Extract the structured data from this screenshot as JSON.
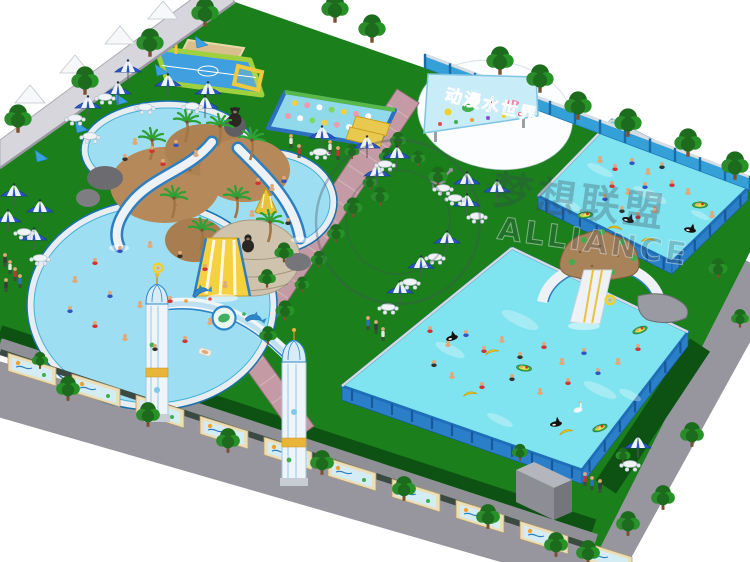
{
  "billboard": {
    "title": "动漫水世界",
    "bg": "#c9edf8",
    "text_color": "#e02828"
  },
  "watermark": {
    "cn": "梦想联盟",
    "en": "ALLIANCE"
  },
  "palette": {
    "lawn": "#1b7f1b",
    "lawn_dark": "#0d5212",
    "pool_water": "#9edef2",
    "frame_pool_water": "#7fe3f0",
    "frame_blue": "#2b7fc8",
    "pool_rim": "#e8edf2",
    "path_pink": "#c49ba4",
    "road_gray": "#97969e",
    "wall_blue": "#35a0d8",
    "wall_gray": "#d6d6dc",
    "umbrella_blue": "#2b58c8",
    "tree_green": "#2c8b2c",
    "palm_green": "#2fa035",
    "rock_tan": "#b5895a",
    "slide_yellow": "#f5d040",
    "gold": "#e8b53a",
    "billboard_bg": "#c9edf8",
    "banana_yellow": "#f2cf2a"
  },
  "scene": {
    "trees_outer": [
      [
        18,
        118
      ],
      [
        85,
        80
      ],
      [
        150,
        42
      ],
      [
        205,
        12
      ],
      [
        335,
        8
      ],
      [
        372,
        28
      ],
      [
        500,
        60
      ],
      [
        540,
        78
      ],
      [
        578,
        105
      ],
      [
        628,
        122
      ],
      [
        688,
        142
      ],
      [
        735,
        165
      ]
    ],
    "trees_road": [
      [
        68,
        388
      ],
      [
        148,
        414
      ],
      [
        228,
        440
      ],
      [
        322,
        462
      ],
      [
        404,
        488
      ],
      [
        488,
        516
      ],
      [
        556,
        544
      ],
      [
        692,
        434
      ],
      [
        663,
        497
      ],
      [
        628,
        523
      ],
      [
        588,
        552
      ]
    ],
    "trees_inner": [
      [
        352,
        151
      ],
      [
        284,
        252
      ],
      [
        267,
        278
      ],
      [
        387,
        156
      ],
      [
        370,
        182
      ],
      [
        353,
        207
      ],
      [
        336,
        233
      ],
      [
        319,
        259
      ],
      [
        302,
        284
      ],
      [
        285,
        310
      ],
      [
        268,
        335
      ],
      [
        398,
        140
      ],
      [
        418,
        158
      ],
      [
        438,
        176
      ],
      [
        380,
        196
      ],
      [
        40,
        360
      ],
      [
        623,
        455
      ],
      [
        718,
        268
      ],
      [
        740,
        318
      ],
      [
        520,
        452
      ]
    ],
    "palms": [
      [
        150,
        160
      ],
      [
        185,
        142
      ],
      [
        218,
        146
      ],
      [
        250,
        160
      ],
      [
        172,
        218
      ],
      [
        235,
        218
      ],
      [
        268,
        242
      ],
      [
        200,
        250
      ]
    ],
    "canopy_tents": [
      [
        30,
        92
      ],
      [
        75,
        62
      ],
      [
        120,
        33
      ],
      [
        163,
        8
      ]
    ],
    "wall_braces": [
      [
        35,
        150
      ],
      [
        75,
        121
      ],
      [
        115,
        93
      ],
      [
        155,
        64
      ],
      [
        195,
        36
      ]
    ],
    "umbrellas": [
      [
        128,
        72
      ],
      [
        168,
        86
      ],
      [
        208,
        94
      ],
      [
        118,
        94
      ],
      [
        205,
        108
      ],
      [
        88,
        108
      ],
      [
        14,
        196
      ],
      [
        40,
        212
      ],
      [
        8,
        222
      ],
      [
        34,
        240
      ],
      [
        367,
        148
      ],
      [
        397,
        158
      ],
      [
        377,
        176
      ],
      [
        467,
        184
      ],
      [
        497,
        192
      ],
      [
        467,
        206
      ],
      [
        447,
        243
      ],
      [
        421,
        268
      ],
      [
        400,
        293
      ],
      [
        638,
        448
      ],
      [
        322,
        138
      ]
    ],
    "tables": [
      [
        105,
        97
      ],
      [
        145,
        107
      ],
      [
        192,
        106
      ],
      [
        75,
        118
      ],
      [
        90,
        136
      ],
      [
        24,
        232
      ],
      [
        40,
        258
      ],
      [
        385,
        164
      ],
      [
        443,
        188
      ],
      [
        455,
        198
      ],
      [
        477,
        216
      ],
      [
        435,
        257
      ],
      [
        410,
        282
      ],
      [
        388,
        307
      ],
      [
        630,
        464
      ],
      [
        320,
        152
      ]
    ],
    "mural_panels": [
      [
        8,
        353
      ],
      [
        72,
        374
      ],
      [
        136,
        395
      ],
      [
        200,
        416
      ],
      [
        264,
        437
      ],
      [
        328,
        458
      ],
      [
        392,
        479
      ],
      [
        456,
        500
      ],
      [
        520,
        521
      ],
      [
        584,
        542
      ]
    ],
    "people_pool_top": [
      [
        135,
        142,
        0
      ],
      [
        152,
        150,
        1
      ],
      [
        176,
        144,
        2
      ],
      [
        196,
        154,
        0
      ],
      [
        125,
        158,
        3
      ],
      [
        163,
        163,
        1
      ]
    ],
    "people_pool_right": [
      [
        258,
        182,
        1
      ],
      [
        272,
        188,
        0
      ],
      [
        284,
        180,
        2
      ],
      [
        252,
        214,
        0
      ],
      [
        288,
        222,
        3
      ]
    ],
    "people_pool_bottom": [
      [
        75,
        280,
        0
      ],
      [
        95,
        262,
        1
      ],
      [
        120,
        250,
        2
      ],
      [
        150,
        245,
        0
      ],
      [
        180,
        255,
        3
      ],
      [
        205,
        268,
        1
      ],
      [
        225,
        285,
        0
      ],
      [
        70,
        310,
        2
      ],
      [
        95,
        325,
        1
      ],
      [
        125,
        338,
        0
      ],
      [
        155,
        348,
        3
      ],
      [
        185,
        340,
        1
      ],
      [
        210,
        322,
        0
      ],
      [
        110,
        295,
        2
      ],
      [
        140,
        305,
        0
      ],
      [
        170,
        300,
        1
      ]
    ],
    "people_pool_topright": [
      [
        600,
        160,
        0
      ],
      [
        615,
        168,
        1
      ],
      [
        632,
        162,
        2
      ],
      [
        648,
        172,
        0
      ],
      [
        662,
        166,
        3
      ],
      [
        612,
        185,
        1
      ],
      [
        628,
        192,
        0
      ],
      [
        645,
        186,
        2
      ],
      [
        672,
        184,
        1
      ],
      [
        688,
        192,
        0
      ],
      [
        622,
        210,
        3
      ],
      [
        638,
        216,
        1
      ],
      [
        655,
        210,
        0
      ],
      [
        605,
        198,
        2
      ],
      [
        700,
        205,
        1
      ],
      [
        712,
        215,
        0
      ]
    ],
    "people_pool_bottomright": [
      [
        430,
        330,
        1
      ],
      [
        448,
        344,
        0
      ],
      [
        466,
        334,
        2
      ],
      [
        484,
        350,
        1
      ],
      [
        502,
        340,
        0
      ],
      [
        520,
        356,
        3
      ],
      [
        544,
        346,
        1
      ],
      [
        562,
        362,
        0
      ],
      [
        584,
        352,
        2
      ],
      [
        452,
        376,
        0
      ],
      [
        482,
        386,
        1
      ],
      [
        512,
        378,
        3
      ],
      [
        540,
        392,
        0
      ],
      [
        568,
        382,
        1
      ],
      [
        598,
        372,
        2
      ],
      [
        618,
        362,
        0
      ],
      [
        638,
        348,
        1
      ],
      [
        434,
        364,
        3
      ]
    ],
    "people_standing": [
      [
        5,
        255
      ],
      [
        10,
        262
      ],
      [
        15,
        269
      ],
      [
        20,
        276
      ],
      [
        6,
        280
      ],
      [
        291,
        136
      ],
      [
        299,
        146
      ],
      [
        368,
        318
      ],
      [
        376,
        322
      ],
      [
        383,
        329
      ],
      [
        585,
        474
      ],
      [
        592,
        478
      ],
      [
        600,
        481
      ],
      [
        330,
        142
      ],
      [
        338,
        148
      ]
    ],
    "floats_topright": [
      [
        "orca",
        628,
        220
      ],
      [
        "orca",
        690,
        230
      ],
      [
        "banana",
        648,
        240
      ],
      [
        "boat",
        700,
        205
      ],
      [
        "boat",
        585,
        215
      ],
      [
        "banana",
        615,
        228
      ]
    ],
    "floats_bottomright": [
      [
        "orca",
        452,
        338
      ],
      [
        "banana",
        492,
        352
      ],
      [
        "boat",
        524,
        368
      ],
      [
        "banana",
        470,
        394
      ],
      [
        "orca",
        556,
        424
      ],
      [
        "banana",
        566,
        432
      ],
      [
        "boat",
        600,
        428
      ],
      [
        "swan",
        578,
        410
      ],
      [
        "boat",
        640,
        330
      ],
      [
        "ring",
        610,
        300
      ]
    ],
    "floats_left": [
      [
        "ring",
        158,
        268
      ],
      [
        "lounger",
        205,
        352
      ]
    ],
    "water_streaks": [
      [
        600,
        170,
        14,
        4
      ],
      [
        650,
        195,
        18,
        5
      ],
      [
        570,
        205,
        12,
        4
      ],
      [
        700,
        215,
        10,
        3
      ],
      [
        450,
        350,
        16,
        5
      ],
      [
        520,
        320,
        20,
        6
      ],
      [
        600,
        390,
        18,
        5
      ],
      [
        630,
        395,
        12,
        4
      ],
      [
        500,
        420,
        14,
        4
      ]
    ]
  }
}
